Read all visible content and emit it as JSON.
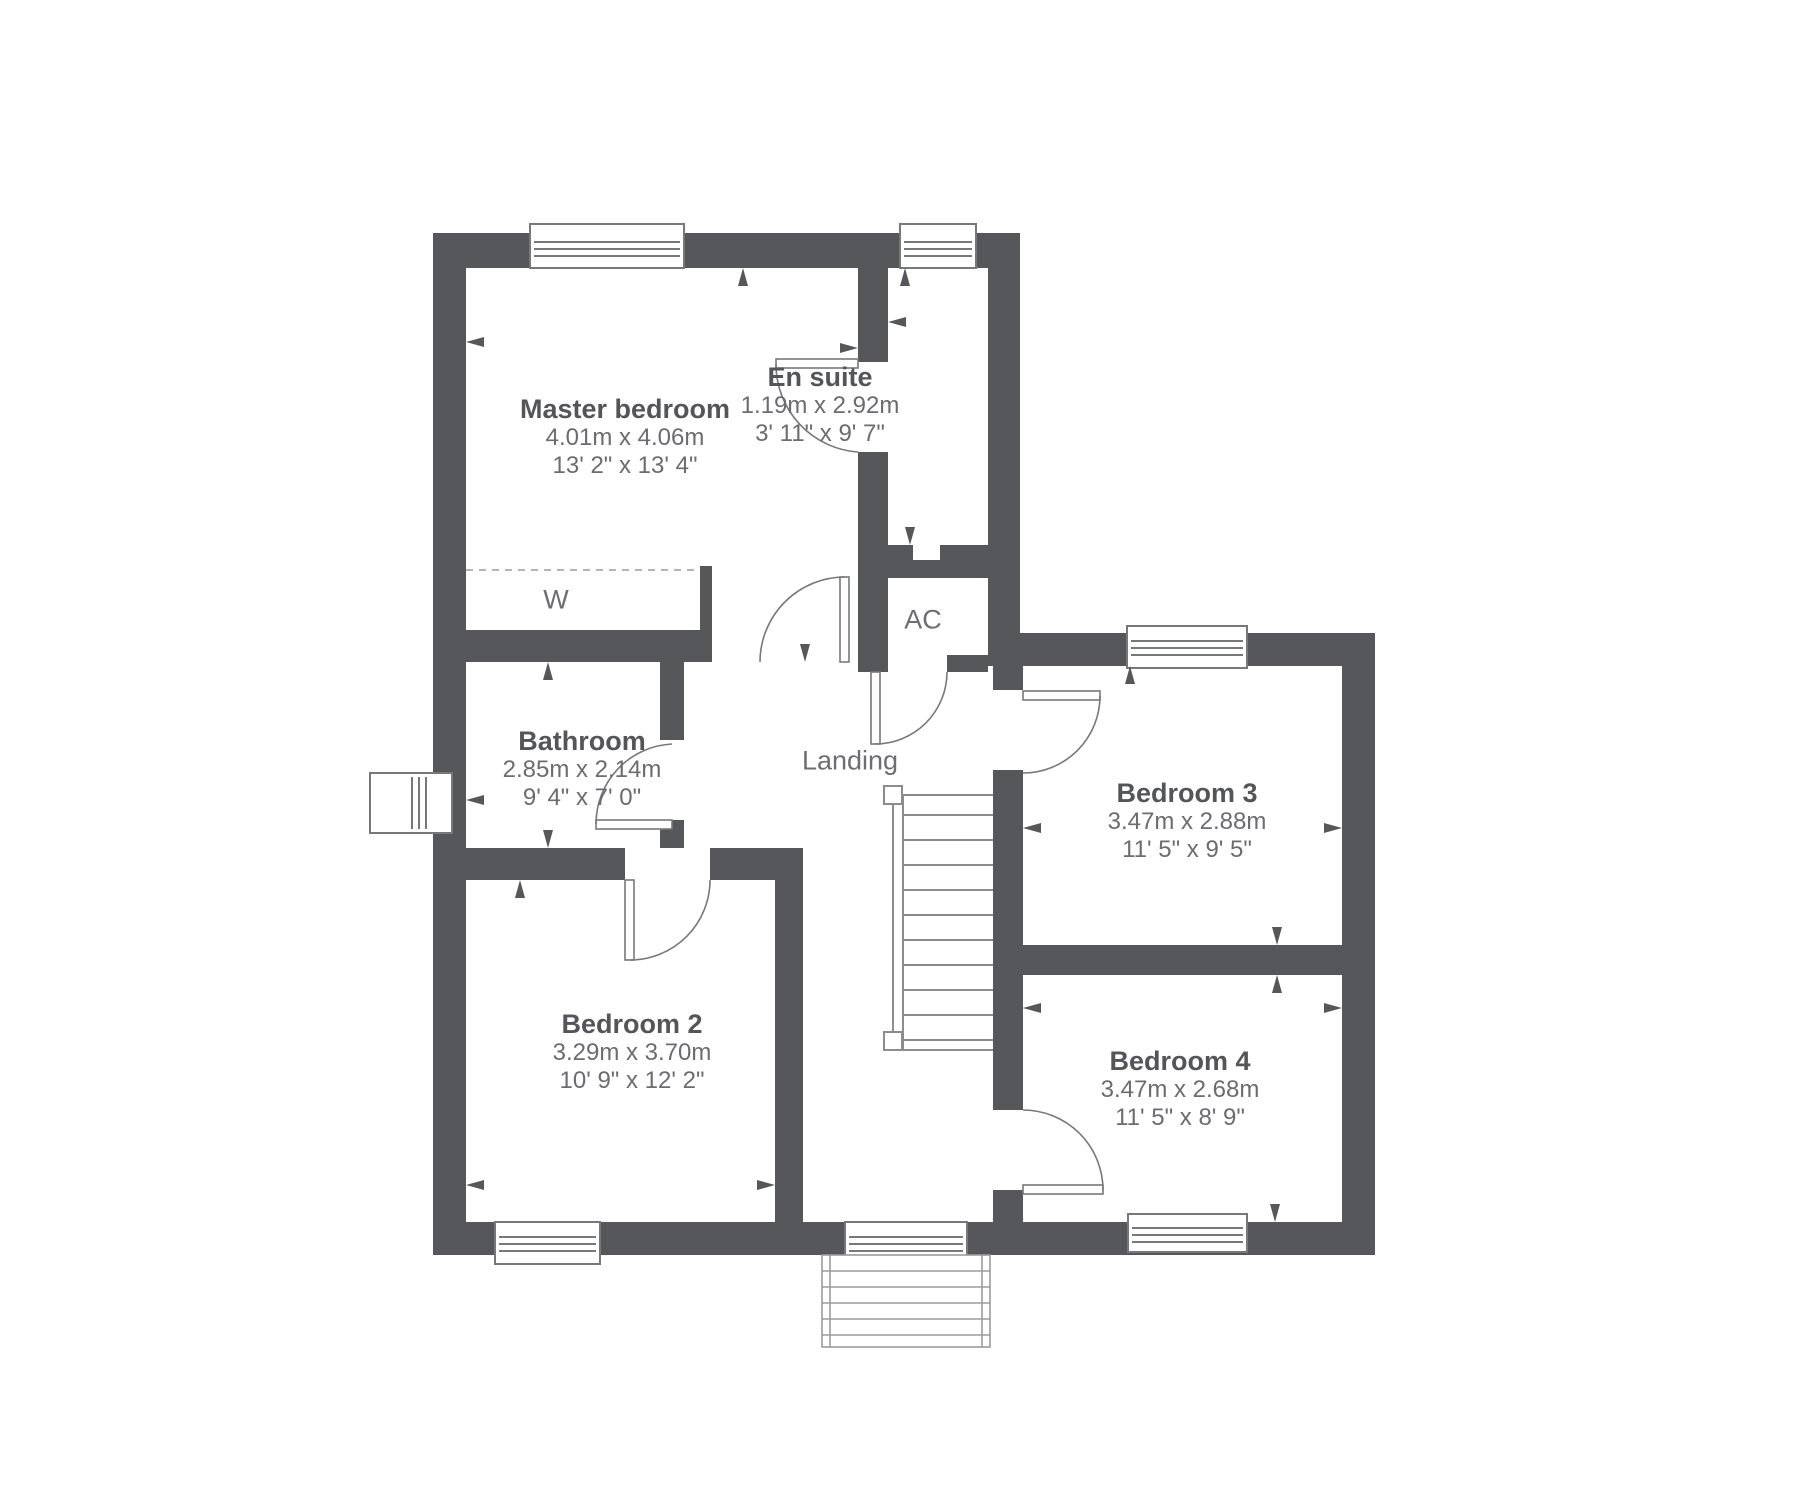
{
  "title": "First floor plan",
  "rooms": {
    "master": {
      "name": "Master bedroom",
      "metric": "4.01m x 4.06m",
      "imperial": "13' 2\" x 13' 4\""
    },
    "ensuite": {
      "name": "En suite",
      "metric": "1.19m x 2.92m",
      "imperial": "3' 11\" x 9' 7\""
    },
    "bathroom": {
      "name": "Bathroom",
      "metric": "2.85m x 2.14m",
      "imperial": "9' 4\" x 7' 0\""
    },
    "bedroom2": {
      "name": "Bedroom 2",
      "metric": "3.29m x 3.70m",
      "imperial": "10' 9\" x 12' 2\""
    },
    "bedroom3": {
      "name": "Bedroom 3",
      "metric": "3.47m x 2.88m",
      "imperial": "11' 5\" x 9' 5\""
    },
    "bedroom4": {
      "name": "Bedroom 4",
      "metric": "3.47m x 2.68m",
      "imperial": "11' 5\" x 8' 9\""
    }
  },
  "areas": {
    "landing": "Landing",
    "wardrobe": "W",
    "airing_cupboard": "AC"
  },
  "colors": {
    "wall": "#56575b",
    "line": "#77787b",
    "tread": "#8b8c8f",
    "dash": "#b5b5b5",
    "room_name_text": "#545559",
    "dimension_text": "#6b6c70"
  }
}
